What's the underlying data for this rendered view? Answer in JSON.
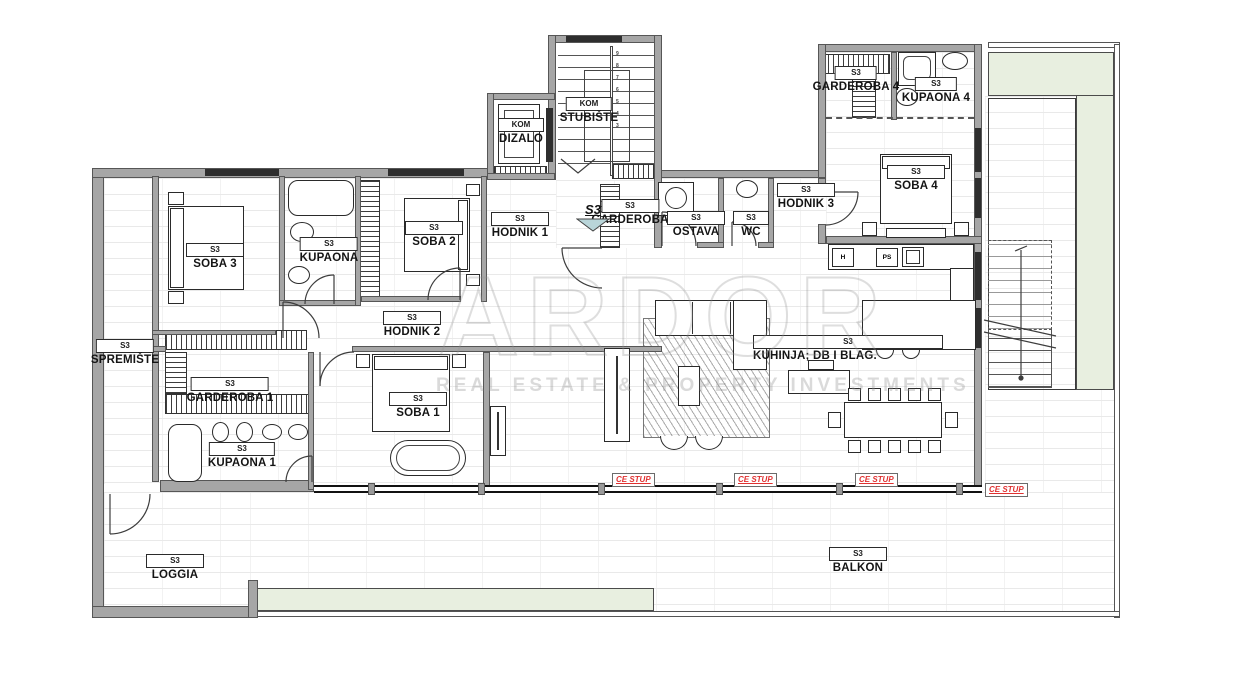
{
  "plan": {
    "entry_marker": "S3",
    "watermark": {
      "title": "ARDOR",
      "subtitle": "REAL ESTATE & PROPERTY INVESTMENTS"
    }
  },
  "rooms": {
    "spremiste": {
      "tag": "S3",
      "name": "SPREMIŠTE"
    },
    "soba3": {
      "tag": "S3",
      "name": "SOBA 3"
    },
    "kupaona": {
      "tag": "S3",
      "name": "KUPAONA"
    },
    "soba2": {
      "tag": "S3",
      "name": "SOBA 2"
    },
    "hodnik1": {
      "tag": "S3",
      "name": "HODNIK 1"
    },
    "dizalo": {
      "tag": "KOM",
      "name": "DIZALO"
    },
    "stubiste": {
      "tag": "KOM",
      "name": "STUBIŠTE"
    },
    "garderoba": {
      "tag": "S3",
      "name": "GARDEROBA"
    },
    "ostava": {
      "tag": "S3",
      "name": "OSTAVA"
    },
    "wc": {
      "tag": "S3",
      "name": "WC"
    },
    "hodnik3": {
      "tag": "S3",
      "name": "HODNIK 3"
    },
    "garderoba4": {
      "tag": "S3",
      "name": "GARDEROBA 4"
    },
    "kupaona4": {
      "tag": "S3",
      "name": "KUPAONA 4"
    },
    "soba4": {
      "tag": "S3",
      "name": "SOBA 4"
    },
    "hodnik2": {
      "tag": "S3",
      "name": "HODNIK 2"
    },
    "garderoba1": {
      "tag": "S3",
      "name": "GARDEROBA 1"
    },
    "soba1": {
      "tag": "S3",
      "name": "SOBA 1"
    },
    "kupaona1": {
      "tag": "S3",
      "name": "KUPAONA 1"
    },
    "kuhinja": {
      "tag": "S3",
      "name": "KUHINJA; DB I BLAG."
    },
    "loggia": {
      "tag": "S3",
      "name": "LOGGIA"
    },
    "balkon": {
      "tag": "S3",
      "name": "BALKON"
    }
  },
  "columns": [
    {
      "label": "CE STUP"
    },
    {
      "label": "CE STUP"
    },
    {
      "label": "CE STUP"
    },
    {
      "label": "CE STUP"
    }
  ],
  "kitchen": {
    "fridge": "H",
    "dishwasher": "PS"
  },
  "stairs": {
    "steps": [
      "9",
      "8",
      "7",
      "6",
      "5",
      "4",
      "3"
    ]
  },
  "colors": {
    "wall": "#a6a6a6",
    "wall_outline": "#565656",
    "green": "#e8efe0",
    "accent_red": "#e03131",
    "marker": "#b9d5d9"
  }
}
